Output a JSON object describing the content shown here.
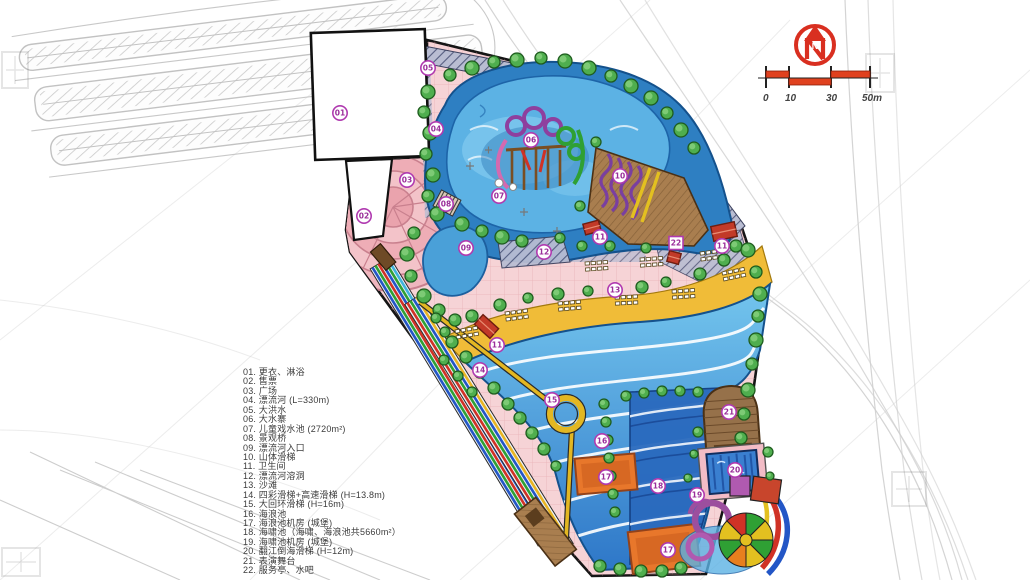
{
  "drawing": {
    "type_hint": "water park master plan (hand rendered site plan)",
    "colors": {
      "river_blue": "#2e7fc2",
      "pool_light": "#5cb2e4",
      "wave_pool_top": "#74c6ee",
      "wave_pool_deep": "#2e77c8",
      "tsunami_blue": "#2a6abe",
      "beach_sand": "#f0bc38",
      "path_pink": "#f6d3d6",
      "plaza_pink": "#efb6be",
      "tree_green": "#4fae4e",
      "slope_brown": "#a97e4f",
      "machine_orange": "#e8772b",
      "marker_purple": "#a435a4",
      "scale_red": "#d93020",
      "sketch_gray": "#cccccc"
    }
  },
  "compass": {
    "label": "N"
  },
  "scalebar": {
    "labels": [
      "0",
      "10",
      "30",
      "50m"
    ]
  },
  "legend": {
    "items": [
      {
        "no": "01.",
        "label": "更衣、淋浴"
      },
      {
        "no": "02.",
        "label": "售票"
      },
      {
        "no": "03.",
        "label": "广场"
      },
      {
        "no": "04.",
        "label": "漂流河 (L=330m)"
      },
      {
        "no": "05.",
        "label": "大洪水"
      },
      {
        "no": "06.",
        "label": "大水寨"
      },
      {
        "no": "07.",
        "label": "儿童戏水池 (2720m²)"
      },
      {
        "no": "08.",
        "label": "景观桥"
      },
      {
        "no": "09.",
        "label": "漂流河入口"
      },
      {
        "no": "10.",
        "label": "山体滑梯"
      },
      {
        "no": "11.",
        "label": "卫生间"
      },
      {
        "no": "12.",
        "label": "漂流河溶洞"
      },
      {
        "no": "13.",
        "label": "沙滩"
      },
      {
        "no": "14.",
        "label": "四彩滑梯+高速滑梯 (H=13.8m)"
      },
      {
        "no": "15.",
        "label": "大回环滑梯 (H=16m)"
      },
      {
        "no": "16.",
        "label": "海浪池"
      },
      {
        "no": "17.",
        "label": "海浪池机房 (城堡)"
      },
      {
        "no": "18.",
        "label": "海啸池（海啸、海浪池共5660m²）"
      },
      {
        "no": "19.",
        "label": "海啸池机房 (城堡)"
      },
      {
        "no": "20.",
        "label": "翻江倒海滑梯 (H=12m)"
      },
      {
        "no": "21.",
        "label": "表演舞台"
      },
      {
        "no": "22.",
        "label": "服务亭、水吧"
      }
    ]
  },
  "plan": {
    "markers": [
      {
        "no": "01",
        "x": 340,
        "y": 113
      },
      {
        "no": "02",
        "x": 364,
        "y": 216
      },
      {
        "no": "03",
        "x": 407,
        "y": 180
      },
      {
        "no": "04",
        "x": 436,
        "y": 129
      },
      {
        "no": "05",
        "x": 428,
        "y": 68
      },
      {
        "no": "06",
        "x": 531,
        "y": 140
      },
      {
        "no": "07",
        "x": 499,
        "y": 196
      },
      {
        "no": "08",
        "x": 446,
        "y": 204
      },
      {
        "no": "09",
        "x": 466,
        "y": 248
      },
      {
        "no": "10",
        "x": 620,
        "y": 176
      },
      {
        "no": "11",
        "x": 600,
        "y": 237
      },
      {
        "no": "11",
        "x": 722,
        "y": 246
      },
      {
        "no": "11",
        "x": 497,
        "y": 345
      },
      {
        "no": "12",
        "x": 544,
        "y": 252
      },
      {
        "no": "13",
        "x": 615,
        "y": 290
      },
      {
        "no": "14",
        "x": 480,
        "y": 370
      },
      {
        "no": "15",
        "x": 552,
        "y": 400
      },
      {
        "no": "16",
        "x": 602,
        "y": 441
      },
      {
        "no": "17",
        "x": 606,
        "y": 477
      },
      {
        "no": "17",
        "x": 668,
        "y": 550
      },
      {
        "no": "18",
        "x": 658,
        "y": 486
      },
      {
        "no": "19",
        "x": 697,
        "y": 495
      },
      {
        "no": "20",
        "x": 735,
        "y": 470
      },
      {
        "no": "21",
        "x": 729,
        "y": 412
      },
      {
        "no": "22",
        "x": 676,
        "y": 243,
        "shape": "square"
      }
    ]
  }
}
